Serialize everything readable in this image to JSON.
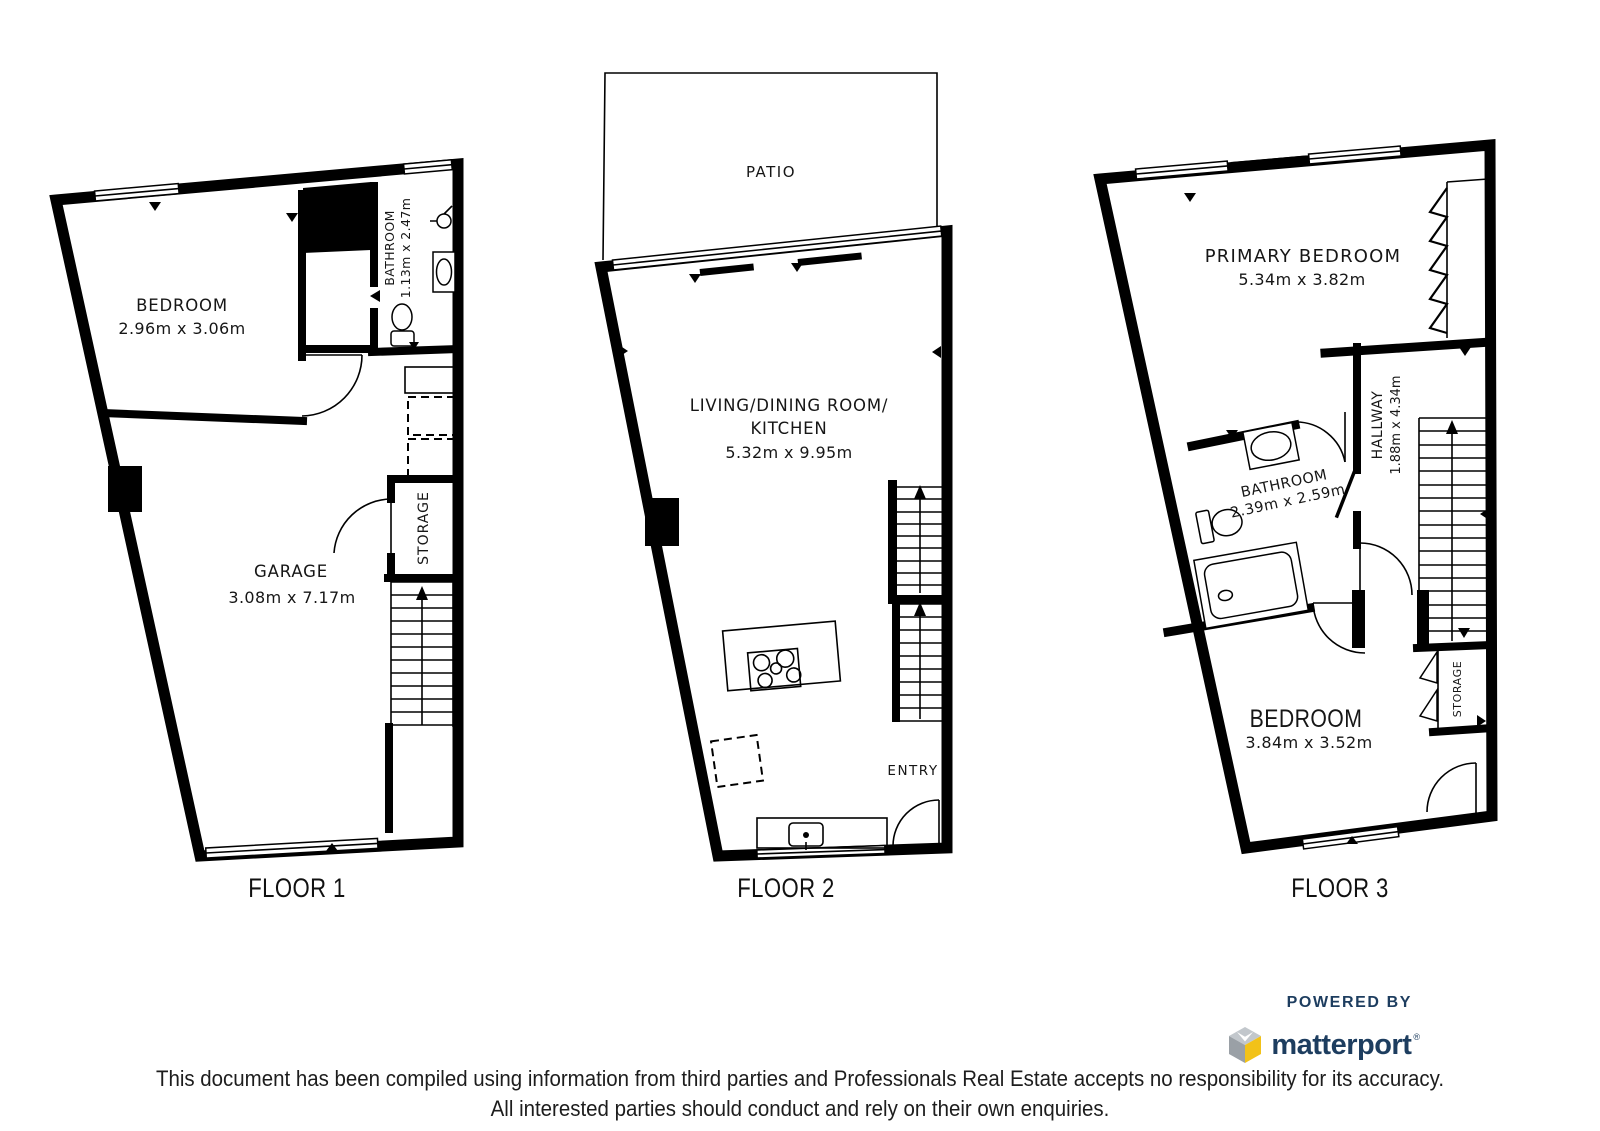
{
  "floors": [
    {
      "label": "FLOOR 1",
      "rooms": {
        "bedroom": {
          "name": "BEDROOM",
          "dims": "2.96m x 3.06m"
        },
        "bathroom": {
          "name": "BATHROOM",
          "dims": "1.13m x 2.47m"
        },
        "garage": {
          "name": "GARAGE",
          "dims": "3.08m x 7.17m"
        },
        "storage": {
          "name": "STORAGE"
        }
      }
    },
    {
      "label": "FLOOR 2",
      "rooms": {
        "patio": {
          "name": "PATIO"
        },
        "living": {
          "name": "LIVING/DINING ROOM/",
          "name_line2": "KITCHEN",
          "dims": "5.32m x 9.95m"
        },
        "entry": {
          "name": "ENTRY"
        }
      }
    },
    {
      "label": "FLOOR 3",
      "rooms": {
        "primary_bedroom": {
          "name": "PRIMARY BEDROOM",
          "dims": "5.34m x 3.82m"
        },
        "hallway": {
          "name": "HALLWAY",
          "dims": "1.88m x 4.34m"
        },
        "bathroom": {
          "name": "BATHROOM",
          "dims": "2.39m x 2.59m"
        },
        "bedroom": {
          "name": "BEDROOM",
          "dims": "3.84m x 3.52m"
        },
        "storage": {
          "name": "STORAGE"
        }
      }
    }
  ],
  "footer": {
    "powered_by": "POWERED BY",
    "brand": "matterport",
    "trademark": "®",
    "disclaimer_line1": "This document has been compiled using information from third parties and Professionals Real Estate accepts no responsibility for its accuracy.",
    "disclaimer_line2": "All interested parties should conduct and rely on their own enquiries."
  },
  "colors": {
    "wall": "#000000",
    "background": "#ffffff",
    "brand_navy": "#1d3d5f",
    "brand_yellow": "#f2c218",
    "brand_gray_light": "#c2c7cc",
    "brand_gray_dark": "#9aa0a6"
  },
  "icons": {
    "logo": "matterport-cube-icon"
  }
}
